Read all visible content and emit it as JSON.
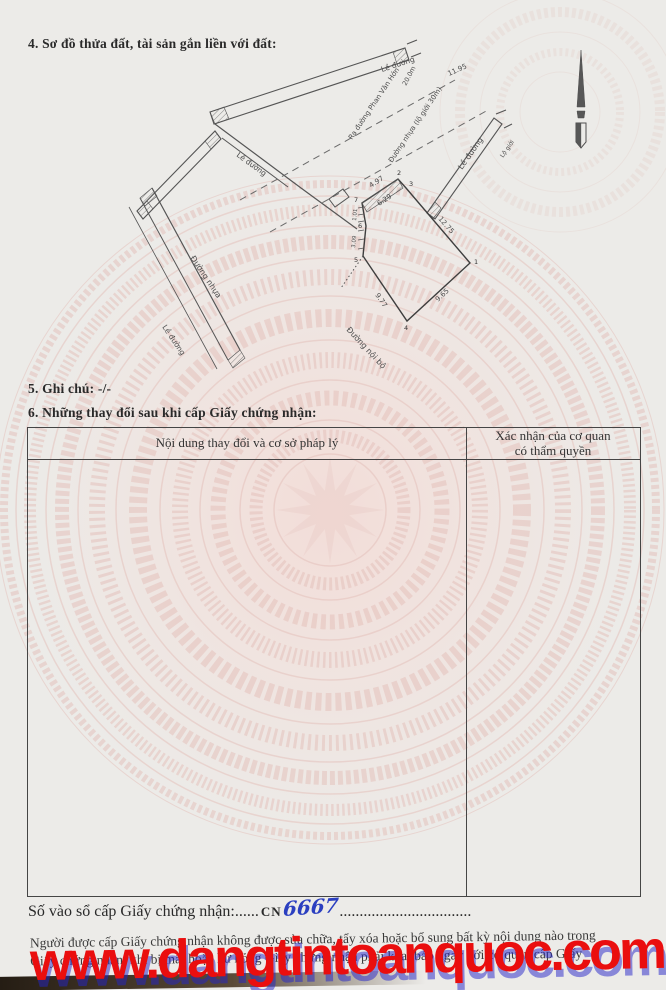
{
  "sections": {
    "s4": "4. Sơ đồ thửa đất, tài sản gắn liền với đất:",
    "s5": "5. Ghi chú: -/-",
    "s6": "6. Những thay đổi sau khi cấp Giấy chứng nhận:"
  },
  "diagram": {
    "road_labels": {
      "top_strip": "Lề đường",
      "right_strip": "Lề đường",
      "corner_strip": "Lề đường",
      "lower_left_strip": "Lề đường",
      "left_road": "Đường nhựa",
      "center_road_1": "Ra đường Phan Văn Hớn",
      "center_road_2": "Đường nhựa (lộ giới 30m)",
      "internal_road": "Đường nội bộ",
      "right_note": "Lộ giới"
    },
    "dims": {
      "front": "4.97",
      "front_inner": "6.29",
      "right_upper": "12.75",
      "right_lower": "9.65",
      "bottom_left": "9.77",
      "left_mid": "3.09",
      "left_small": "1.01",
      "road_width": "20.0m",
      "road_length": "11.95"
    },
    "vertices": [
      "1",
      "2",
      "3",
      "4",
      "5",
      "6",
      "7"
    ]
  },
  "table": {
    "col1_header": "Nội dung thay đổi và cơ sở pháp lý",
    "col2_header_l1": "Xác nhận của cơ quan",
    "col2_header_l2": "có thẩm quyền"
  },
  "footer": {
    "registry_label": "Số vào sổ cấp Giấy chứng nhận:",
    "registry_dots1": "......",
    "registry_prefix": "CN",
    "registry_number": "6667",
    "registry_dots2": ".................................",
    "notice_line1": "Người được cấp Giấy chứng nhận không được sửa chữa, tẩy xóa hoặc bổ sung bất kỳ nội dung nào trong",
    "notice_line2": "Giấy chứng nhận; khi bị mất hoặc hư hỏng Giấy chứng nhận phải khai báo ngay với cơ quan cấp Giấy"
  },
  "watermark": {
    "url": "www.dangtintoanquoc.com",
    "color": "#ea0e0e",
    "shadow_color": "#2323c8"
  },
  "colors": {
    "paper": "#ecebe8",
    "drum_pink": "#e4bfb9",
    "ink": "#2a2a2a",
    "handwriting_blue": "#2b3fc0"
  }
}
